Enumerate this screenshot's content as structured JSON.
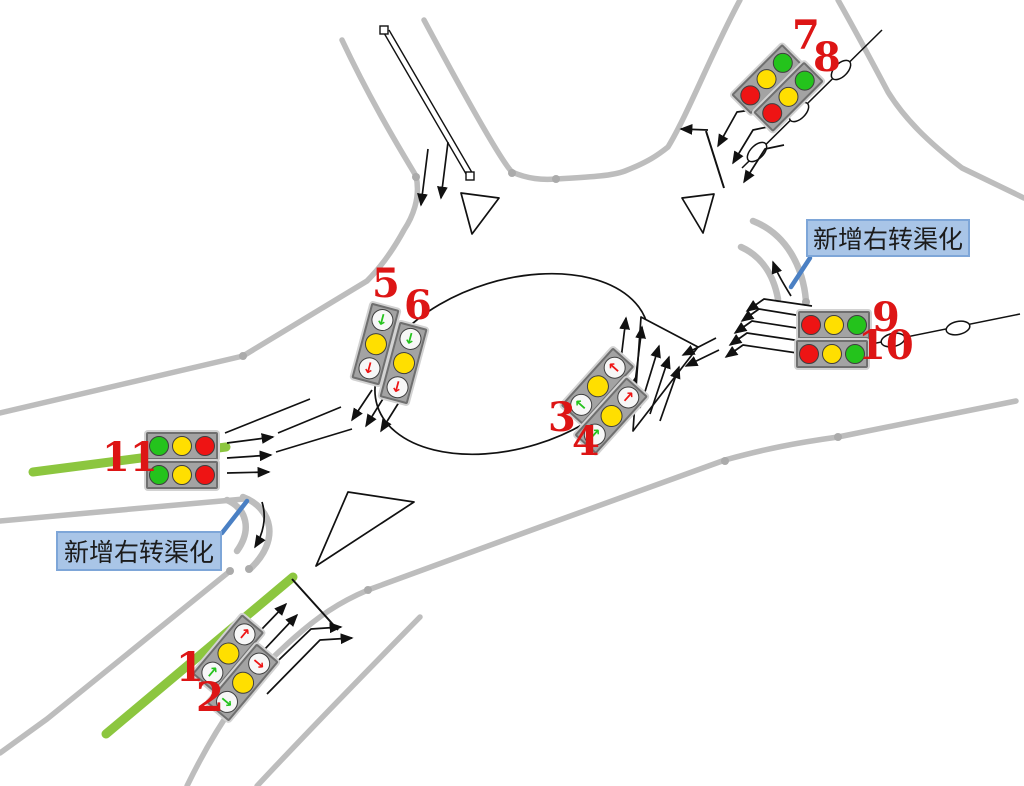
{
  "annotations": {
    "right_turn_note_ne": "新增右转渠化",
    "right_turn_note_sw": "新增右转渠化"
  },
  "signal_numbers": [
    {
      "text": "1"
    },
    {
      "text": "2"
    },
    {
      "text": "3"
    },
    {
      "text": "4"
    },
    {
      "text": "5"
    },
    {
      "text": "6"
    },
    {
      "text": "7"
    },
    {
      "text": "8"
    },
    {
      "text": "9"
    },
    {
      "text": "10"
    },
    {
      "text": "11"
    }
  ],
  "signal_heads": {
    "1": {
      "orientation": "vertical",
      "lenses": [
        {
          "color": "red",
          "arrow": "↑"
        },
        {
          "color": "yellow",
          "arrow": ""
        },
        {
          "color": "green",
          "arrow": "↑"
        }
      ]
    },
    "2": {
      "orientation": "vertical",
      "lenses": [
        {
          "color": "red",
          "arrow": "→"
        },
        {
          "color": "yellow",
          "arrow": ""
        },
        {
          "color": "green",
          "arrow": "→"
        }
      ]
    },
    "3": {
      "orientation": "vertical",
      "lenses": [
        {
          "color": "red",
          "arrow": "←"
        },
        {
          "color": "yellow",
          "arrow": ""
        },
        {
          "color": "green",
          "arrow": "←"
        }
      ]
    },
    "4": {
      "orientation": "vertical",
      "lenses": [
        {
          "color": "red",
          "arrow": "↑"
        },
        {
          "color": "yellow",
          "arrow": ""
        },
        {
          "color": "green",
          "arrow": "↑"
        }
      ]
    },
    "5": {
      "orientation": "vertical",
      "lenses": [
        {
          "color": "green",
          "arrow": "↓"
        },
        {
          "color": "yellow",
          "arrow": ""
        },
        {
          "color": "red",
          "arrow": "↓"
        }
      ]
    },
    "6": {
      "orientation": "vertical",
      "lenses": [
        {
          "color": "green",
          "arrow": "↓"
        },
        {
          "color": "yellow",
          "arrow": ""
        },
        {
          "color": "red",
          "arrow": "↓"
        }
      ]
    },
    "7": {
      "orientation": "horizontal",
      "lenses": [
        {
          "color": "red",
          "arrow": ""
        },
        {
          "color": "yellow",
          "arrow": ""
        },
        {
          "color": "green",
          "arrow": ""
        }
      ]
    },
    "8": {
      "orientation": "horizontal",
      "lenses": [
        {
          "color": "red",
          "arrow": ""
        },
        {
          "color": "yellow",
          "arrow": ""
        },
        {
          "color": "green",
          "arrow": ""
        }
      ]
    },
    "9": {
      "orientation": "horizontal",
      "lenses": [
        {
          "color": "red",
          "arrow": ""
        },
        {
          "color": "yellow",
          "arrow": ""
        },
        {
          "color": "green",
          "arrow": ""
        }
      ]
    },
    "10": {
      "orientation": "horizontal",
      "lenses": [
        {
          "color": "red",
          "arrow": ""
        },
        {
          "color": "yellow",
          "arrow": ""
        },
        {
          "color": "green",
          "arrow": ""
        }
      ]
    },
    "11_top": {
      "orientation": "horizontal",
      "lenses": [
        {
          "color": "green",
          "arrow": ""
        },
        {
          "color": "yellow",
          "arrow": ""
        },
        {
          "color": "red",
          "arrow": ""
        }
      ]
    },
    "11_bottom": {
      "orientation": "horizontal",
      "lenses": [
        {
          "color": "green",
          "arrow": ""
        },
        {
          "color": "yellow",
          "arrow": ""
        },
        {
          "color": "red",
          "arrow": ""
        }
      ]
    }
  },
  "colors": {
    "red": "#ee1414",
    "yellow": "#ffdf00",
    "green": "#24c31c",
    "arrow_lens_bg": "#f7f7f7",
    "road_gray": "#bdbdbd",
    "lane_green": "#8cc63f",
    "label_bg": "#a9c5e7",
    "label_border": "#7ea6d8",
    "leader_blue": "#4a80c4",
    "number_red": "#dd1515"
  }
}
